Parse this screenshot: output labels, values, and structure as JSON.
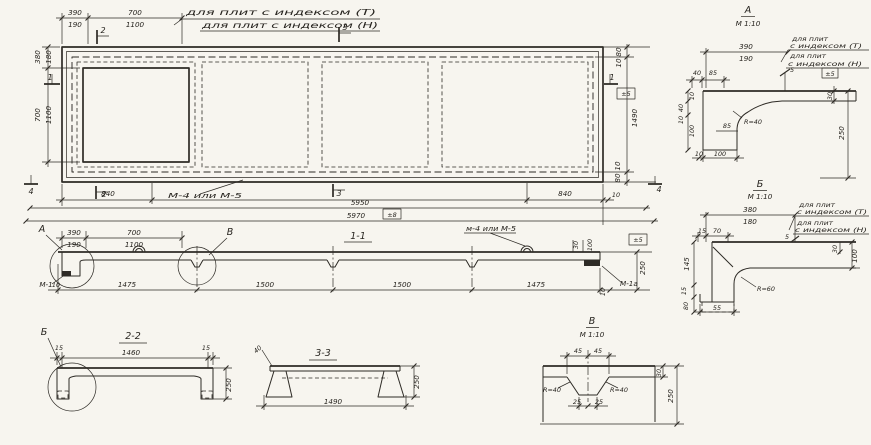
{
  "document": {
    "kind": "precast concrete ribbed slab working drawing",
    "language": "ru"
  },
  "colors": {
    "ink": "#2e2b26",
    "paper": "#f7f5ef"
  },
  "plan": {
    "notes": {
      "line1": "для плит с индексом (Т)",
      "line2": "для плит с индексом (Н)"
    },
    "weld_label": "М-4 или М-5",
    "marks": {
      "m1": "1",
      "m2": "2",
      "m3": "3",
      "m4": "4"
    },
    "dims": {
      "top_390": "390",
      "top_190": "190",
      "top_700": "700",
      "top_1100": "1100",
      "left_380": "380",
      "left_180": "180",
      "left_700": "700",
      "left_1100": "1100",
      "right_80_top": "80",
      "right_10_top": "10",
      "right_1490": "1490",
      "right_10_bot": "10",
      "right_80_bot": "80",
      "bot_840_left": "840",
      "bot_840_right": "840",
      "bot_10": "10",
      "total_5950": "5950",
      "total_5970": "5970",
      "tol_5": "±5",
      "tol_8": "±8"
    }
  },
  "section_1_1": {
    "title": "1-1",
    "detail_a_label": "А",
    "detail_b_label": "В",
    "mark_m1": "М-1",
    "mark_m1a": "М-1а",
    "weld_label": "м-4 или М-5",
    "dims": {
      "d390": "390",
      "d190": "190",
      "d700": "700",
      "d1100": "1100",
      "d10_left": "10",
      "d1475_left": "1475",
      "d1500_left": "1500",
      "d1500_right": "1500",
      "d1475_right": "1475",
      "d10_right": "10",
      "d30": "30",
      "d100": "100",
      "d250": "250",
      "tol_5": "±5"
    }
  },
  "detail_a": {
    "title": "А",
    "scale": "М 1:10",
    "notes": {
      "line1a": "для плит",
      "line1b": "с индексом (Т)",
      "line2a": "для плит",
      "line2b": "с индексом (Н)"
    },
    "dims": {
      "d390": "390",
      "d190": "190",
      "d40": "40",
      "d85": "85",
      "d5": "5",
      "d10_top": "10",
      "d40_left": "40",
      "d100_left": "100",
      "d10_left": "10",
      "r40": "R=40",
      "d85_mid": "85",
      "d10_bot": "10",
      "d100_bot": "100",
      "d30": "30",
      "d250": "250",
      "tol_5": "±5"
    }
  },
  "detail_b": {
    "title": "Б",
    "scale": "М 1:10",
    "notes": {
      "line1a": "для плит",
      "line1b": "с индексом (Т)",
      "line2a": "для плит",
      "line2b": "с индексом (Н)"
    },
    "dims": {
      "d380": "380",
      "d180": "180",
      "d15": "15",
      "d70": "70",
      "d5": "5",
      "d145": "145",
      "d15_left": "15",
      "d80": "80",
      "d55": "55",
      "r60": "R=60",
      "d30": "30",
      "d100": "100"
    }
  },
  "section_2_2": {
    "title": "2-2",
    "detail_label": "Б",
    "dims": {
      "d15_left": "15",
      "d1460": "1460",
      "d15_right": "15",
      "d250": "250"
    }
  },
  "section_3_3": {
    "title": "3-3",
    "dims": {
      "d40": "40",
      "d1490": "1490",
      "d250": "250"
    }
  },
  "detail_v": {
    "title": "В",
    "scale": "М 1:10",
    "dims": {
      "d45_left": "45",
      "d45_right": "45",
      "r40_left": "R=40",
      "r40_right": "R=40",
      "d25_left": "25",
      "d25_right": "25",
      "d30": "30",
      "d250": "250"
    }
  }
}
